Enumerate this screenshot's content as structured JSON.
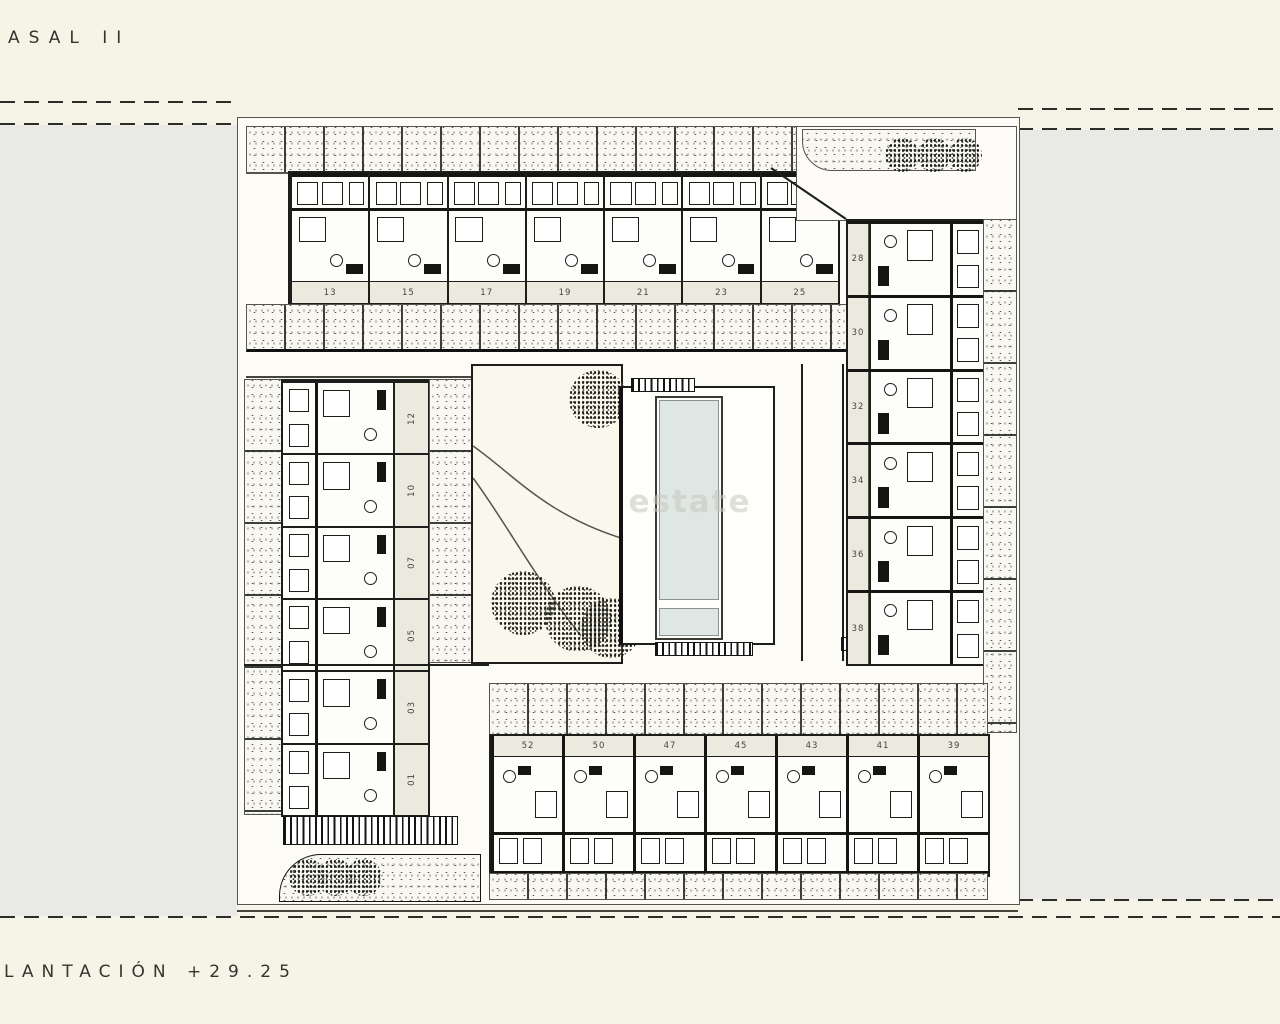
{
  "page": {
    "title": "ASAL II",
    "plan_label": "LANTACIÓN +29.25",
    "watermark": "estate",
    "colors": {
      "background": "#f6f3e7",
      "margin_gray": "#e9e9e6",
      "paper": "#fcfbf6",
      "line": "#1d1d1b",
      "pool_water": "#dfe7e5",
      "number_band": "#eceade",
      "courtyard": "#faf8ec"
    }
  },
  "plan": {
    "top_row_units": [
      "13",
      "15",
      "17",
      "19",
      "21",
      "23",
      "25"
    ],
    "left_column_units": [
      "12",
      "10",
      "07",
      "05",
      "03",
      "01"
    ],
    "right_column_units": [
      "28",
      "30",
      "32",
      "34",
      "36",
      "38"
    ],
    "bottom_row_units": [
      "52",
      "50",
      "47",
      "45",
      "43",
      "41",
      "39"
    ],
    "landscape": {
      "courtyard_trees": 4,
      "top_right_trees": 3,
      "bottom_left_trees": 3,
      "pool_sections": 2
    }
  }
}
